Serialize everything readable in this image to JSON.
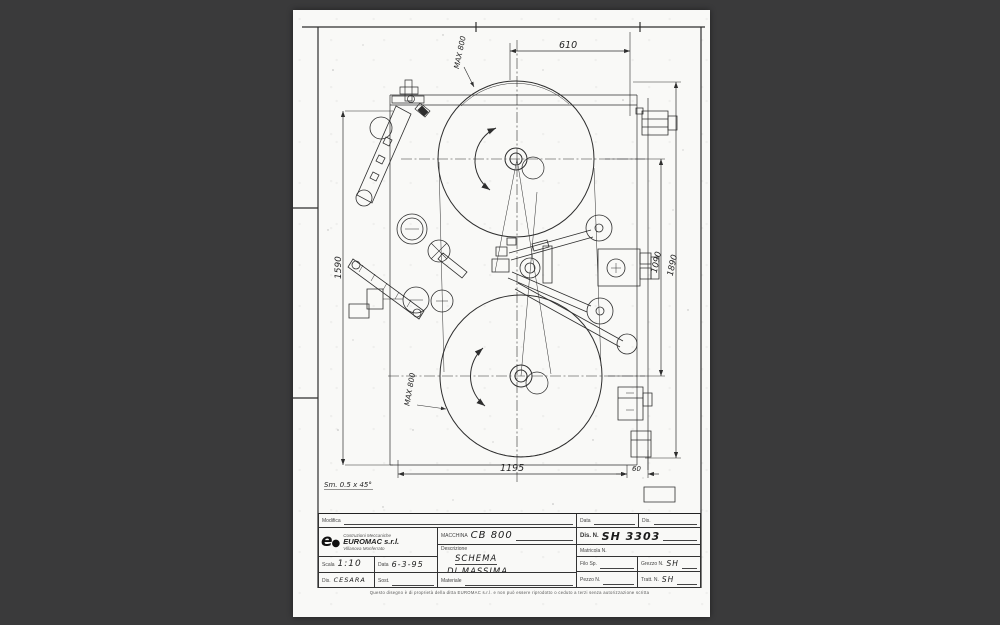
{
  "colors": {
    "background": "#3a3a3b",
    "paper": "#f9f9f7",
    "ink": "#2e2e2e"
  },
  "drawing": {
    "dims": {
      "top_width": "610",
      "max_top": "MAX 800",
      "left_height": "1590",
      "wheel_centers": "1090",
      "overall_height": "1890",
      "max_bottom": "MAX 800",
      "bottom_width": "1195",
      "bottom_offset": "60"
    },
    "chamfer_note": "Sm. 0.5 x 45°"
  },
  "title_block": {
    "modifica_label": "Modifica",
    "data_label": "Data",
    "dis_label": "Dis.",
    "company": {
      "tagline": "Costruzioni Meccaniche",
      "name": "EUROMAC s.r.l.",
      "city": "Villanova Monferrato"
    },
    "macchina": {
      "label": "MACCHINA",
      "value": "CB 800"
    },
    "dis_n": {
      "label": "Dis. N.",
      "value": "SH 3303"
    },
    "descrizione": {
      "label": "Descrizione",
      "value_line1": "SCHEMA",
      "value_line2": "DI MASSIMA"
    },
    "matricola_label": "Matricola N.",
    "scala": {
      "label": "Scala",
      "value": "1:10"
    },
    "data_field": {
      "label": "Data",
      "value": "6-3-95"
    },
    "dis_field": {
      "label": "Dis.",
      "value": "CESARA"
    },
    "sost_label": "Sost.",
    "materiale_label": "Materiale",
    "filo": {
      "label": "Filo Sp."
    },
    "grezzo": {
      "label": "Grezzo N.",
      "value": "SH"
    },
    "pezzo": {
      "label": "Pezzo N."
    },
    "tratt": {
      "label": "Tratt. N.",
      "value": "SH"
    },
    "footer_note": "Questo disegno è di proprietà della ditta EUROMAC s.r.l. e non può essere riprodotto o ceduto a terzi senza autorizzazione scritta"
  }
}
